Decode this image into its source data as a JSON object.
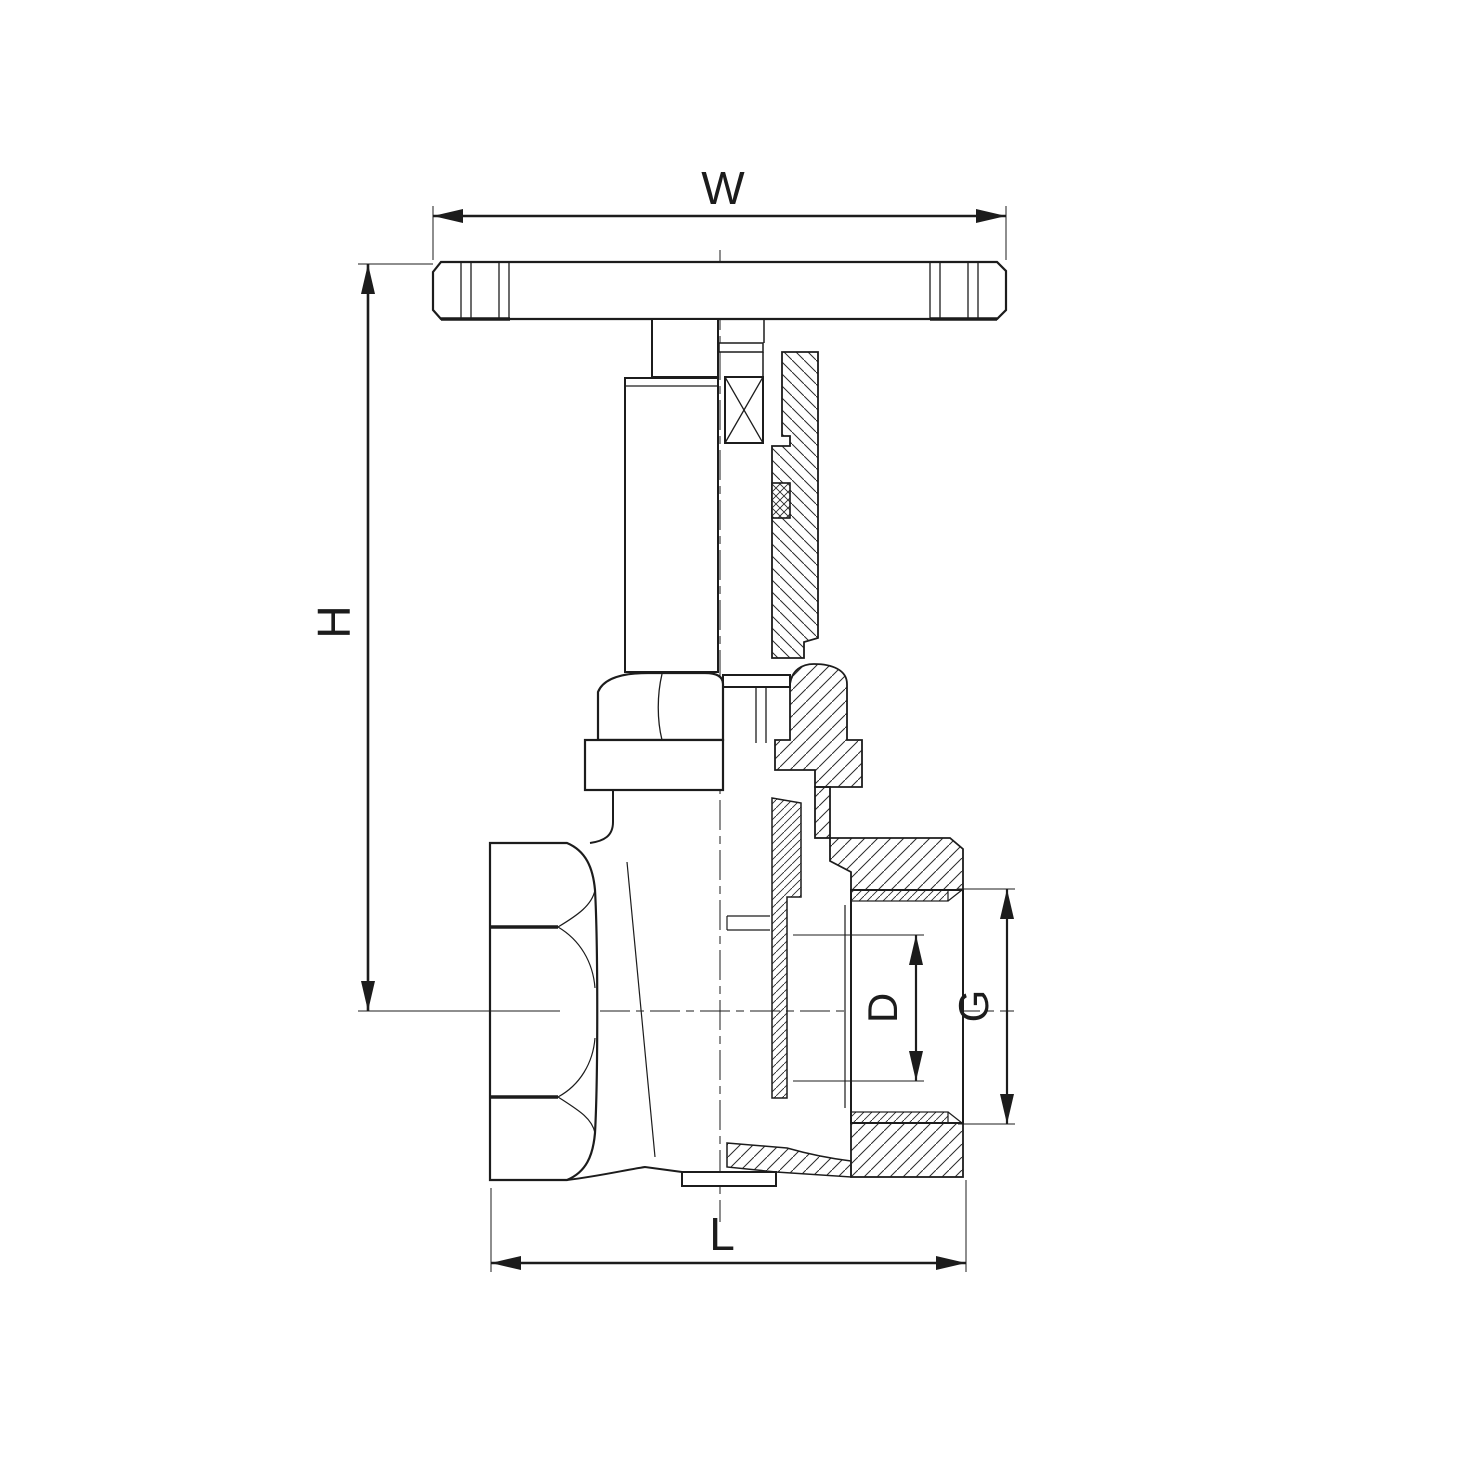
{
  "page": {
    "background": "#ffffff",
    "line_color": "#1c1c1c"
  },
  "drawing": {
    "type": "gate-valve-cross-section",
    "dimension_labels": {
      "width": "W",
      "height": "H",
      "bore_diameter": "D",
      "port_diameter": "G",
      "length": "L"
    }
  }
}
